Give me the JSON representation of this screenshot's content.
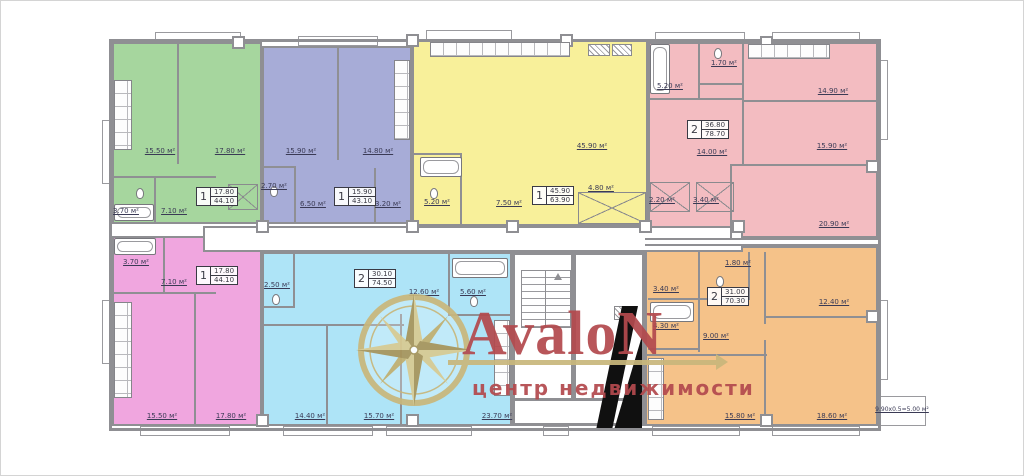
{
  "logo": {
    "brand": "AvaloN",
    "tagline": "центр недвижимости"
  },
  "palette": {
    "green": "#a6d69e",
    "purple": "#a7acd7",
    "yellow": "#f8f09a",
    "pink": "#f3bcc1",
    "magenta": "#f0a6df",
    "blue": "#aee4f7",
    "orange": "#f5c289",
    "wall": "#8f8f93",
    "label_text": "#3a3a55",
    "logo_red": "#b34a4e",
    "logo_gold": "#c9b77c"
  },
  "apartments": {
    "green": {
      "rooms": "1",
      "living": "17.80",
      "total": "44.10",
      "areas": {
        "kitchen": "15.50 м²",
        "room": "17.80 м²",
        "bath": "3.70 м²",
        "hall": "7.10 м²"
      }
    },
    "purple": {
      "rooms": "1",
      "living": "15.90",
      "total": "43.10",
      "areas": {
        "room": "15.90 м²",
        "kitchen": "14.80 м²",
        "wc": "2.70 м²",
        "hall": "6.50 м²",
        "bath": "3.20 м²"
      }
    },
    "yellow": {
      "rooms": "1",
      "living": "45.90",
      "total": "63.90",
      "areas": {
        "studio": "45.90 м²",
        "bath": "5.20 м²",
        "hall": "7.50 м²",
        "closet": "4.80 м²"
      }
    },
    "pink": {
      "rooms": "2",
      "living": "36.80",
      "total": "78.70",
      "areas": {
        "bath": "5.20 м²",
        "wc": "1.70 м²",
        "kitchen": "14.90 м²",
        "room1": "15.90 м²",
        "hall": "14.00 м²",
        "room2": "20.90 м²",
        "closet1": "2.20 м²",
        "closet2": "3.40 м²"
      }
    },
    "magenta": {
      "rooms": "1",
      "living": "17.80",
      "total": "44.10",
      "areas": {
        "bath": "3.70 м²",
        "hall": "7.10 м²",
        "kitchen": "15.50 м²",
        "room": "17.80 м²"
      }
    },
    "blue": {
      "rooms": "2",
      "living": "30.10",
      "total": "74.50",
      "areas": {
        "wc": "2.50 м²",
        "hall": "12.60 м²",
        "bath": "5.60 м²",
        "room1": "14.40 м²",
        "room2": "15.70 м²",
        "kitchen_living": "23.70 м²"
      }
    },
    "orange": {
      "rooms": "2",
      "living": "31.00",
      "total": "70.30",
      "areas": {
        "closet": "3.40 м²",
        "wc": "1.80 м²",
        "bath": "4.30 м²",
        "hall": "9.00 м²",
        "room1": "12.40 м²",
        "kitchen": "15.80 м²",
        "room2": "18.60 м²",
        "balcony": "9.90x0.5=5.00 м²"
      }
    }
  }
}
